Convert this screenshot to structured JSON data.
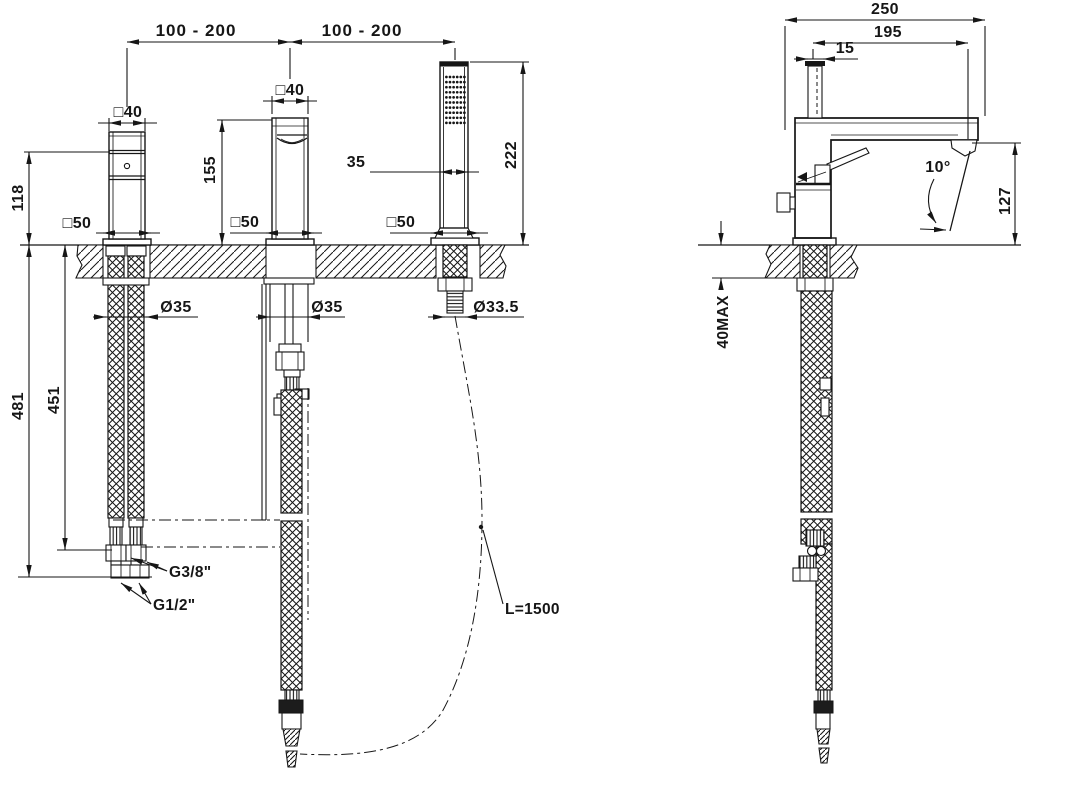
{
  "drawing": {
    "type": "technical-dimension-drawing",
    "subject": "3-hole deck-mounted bath mixer with spout and hand shower — front and side installation views",
    "units": "mm",
    "front": {
      "span_left": "100 - 200",
      "span_right": "100 - 200",
      "mixer_square": "□40",
      "spout_square": "□40",
      "mixer_base_square": "□50",
      "spout_base_square": "□50",
      "shower_base_square": "□50",
      "mixer_height": "118",
      "spout_height": "155",
      "shower_height": "222",
      "shower_width": "35",
      "mixer_hole_dia": "Ø35",
      "spout_hole_dia": "Ø35",
      "shower_hole_dia": "Ø33.5",
      "depth_to_g12": "481",
      "depth_to_g38": "451",
      "thread_small": "G3/8\"",
      "thread_big": "G1/2\"",
      "shower_hose_length": "L=1500"
    },
    "side": {
      "total_depth": "250",
      "spout_reach": "195",
      "rod_width": "15",
      "spout_angle": "10°",
      "outlet_height": "127",
      "deck_thickness_max": "40MAX"
    }
  }
}
